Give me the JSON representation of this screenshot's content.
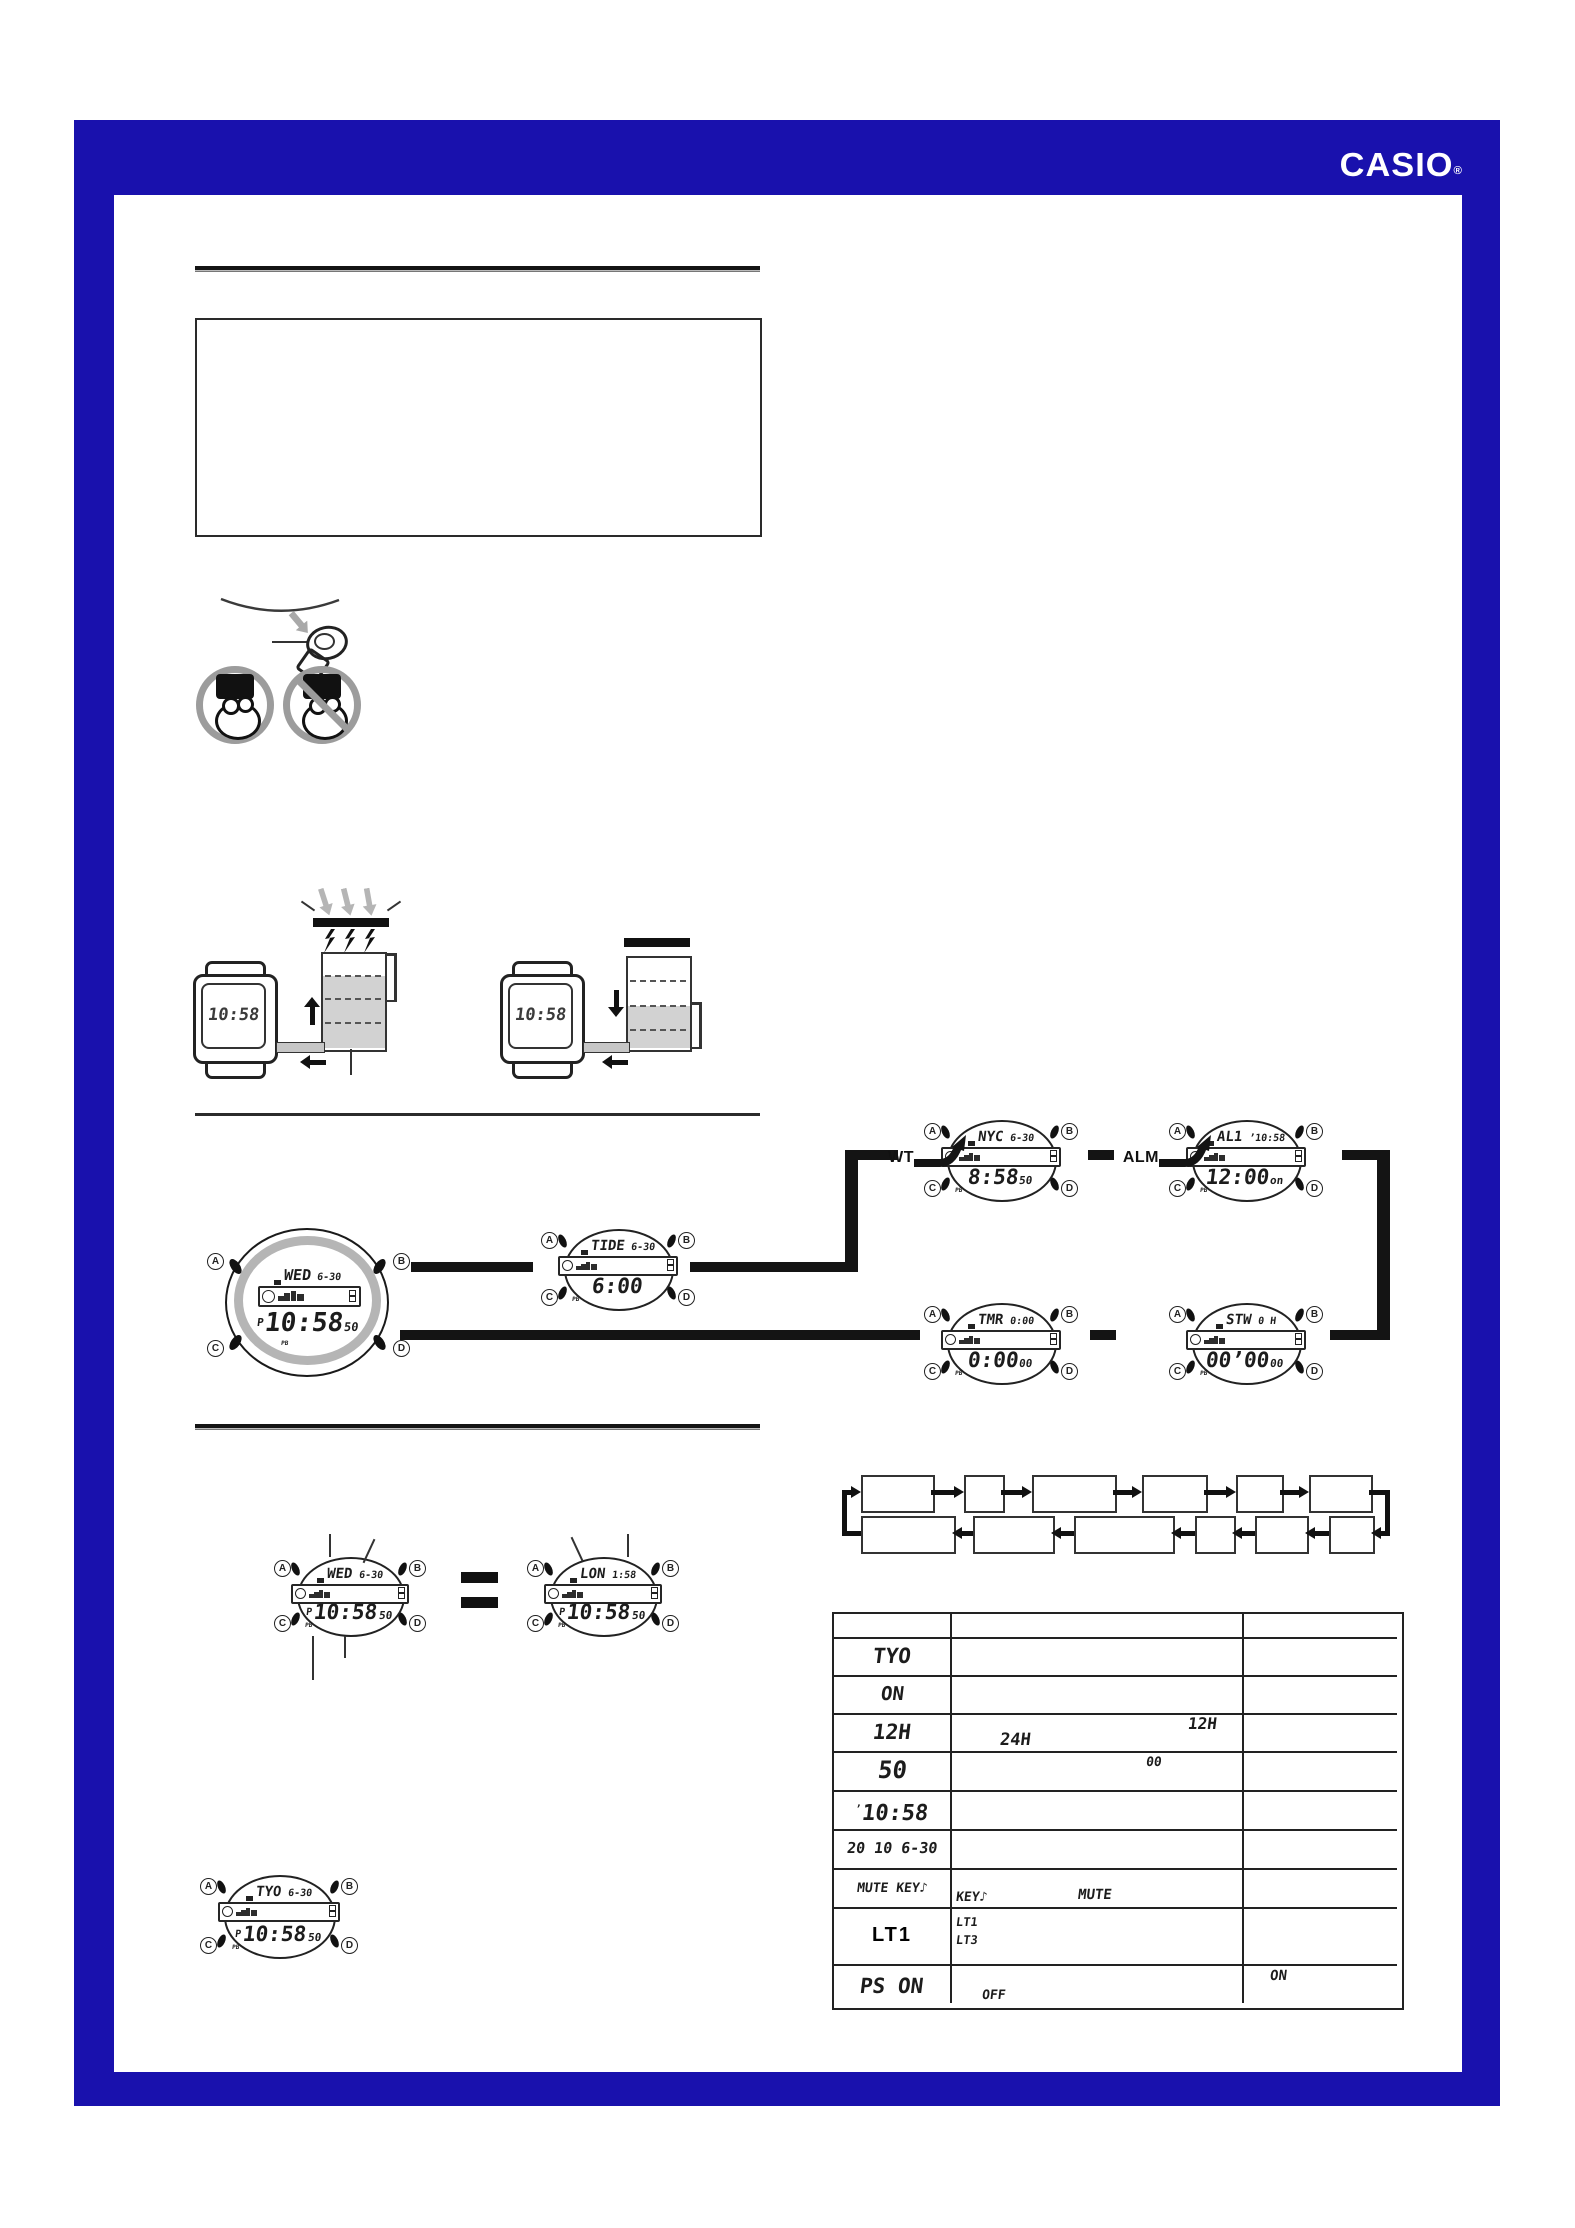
{
  "page": {
    "background": "#ffffff",
    "frame_color": "#1911ad",
    "line_color": "#141414"
  },
  "header": {
    "logo": "CASIO",
    "registered": "®"
  },
  "button_letters": [
    "A",
    "B",
    "C",
    "D"
  ],
  "charge_diagram": {
    "left_watch_time": "10:58",
    "right_watch_time": "10:58",
    "light_icon": "light-rays-arrows",
    "bolt_icon": "charge-lightning-bolts"
  },
  "mode_nav": {
    "main_watch": {
      "city": "WED",
      "date": "6-30",
      "prefix": "P",
      "time": "10:58",
      "suffix": "50",
      "sub": "PB"
    },
    "watches": [
      {
        "id": "tide",
        "city": "TIDE",
        "date": "6-30",
        "prefix": "",
        "time": "6:00",
        "suffix": "",
        "sub": "PB"
      },
      {
        "id": "wt",
        "label": "WT",
        "city": "NYC",
        "date": "6-30",
        "prefix": "",
        "time": "8:58",
        "suffix": "50",
        "sub": "PB"
      },
      {
        "id": "alm",
        "label": "ALM",
        "city": "AL1",
        "date": "’10:58",
        "prefix": "",
        "time": "12:00",
        "suffix": "on",
        "sub": "PB"
      },
      {
        "id": "tmr",
        "city": "TMR",
        "date": "0:00",
        "prefix": "",
        "time": "0:00",
        "suffix": "00",
        "sub": "PB"
      },
      {
        "id": "stw",
        "city": "STW",
        "date": "0 H",
        "prefix": "",
        "time": "00’00",
        "suffix": "00",
        "sub": "PB"
      }
    ]
  },
  "comparison": {
    "equals_symbol": "=",
    "left": {
      "city": "WED",
      "date": "6-30",
      "prefix": "P",
      "time": "10:58",
      "suffix": "50",
      "sub": "PB"
    },
    "right": {
      "city": "LON",
      "date": "1:58",
      "prefix": "P",
      "time": "10:58",
      "suffix": "50",
      "sub": "PB"
    }
  },
  "home_watch": {
    "city": "TYO",
    "date": "6-30",
    "prefix": "P",
    "time": "10:58",
    "suffix": "50",
    "sub": "PB"
  },
  "settings_table": {
    "rows": [
      {
        "label": "",
        "size": 0
      },
      {
        "label": "TYO",
        "size": 21
      },
      {
        "label": "ON",
        "size": 19
      },
      {
        "label": "12H",
        "size": 21,
        "extras": [
          {
            "text": "24H",
            "x": 50,
            "y": 17,
            "size": 17
          },
          {
            "text": "12H",
            "x": 238,
            "y": 1,
            "size": 16
          }
        ]
      },
      {
        "label": "50",
        "size": 24,
        "extras": [
          {
            "text": "00",
            "x": 196,
            "y": 2,
            "size": 13
          }
        ]
      },
      {
        "label": "10:58",
        "size": 22,
        "pre": "’"
      },
      {
        "label": "20 10  6-30",
        "size": 15
      },
      {
        "label": "MUTE KEY♪",
        "size": 13,
        "extras": [
          {
            "text": "KEY♪",
            "x": 6,
            "y": 20,
            "size": 13
          },
          {
            "text": "MUTE",
            "x": 128,
            "y": 18,
            "size": 14
          }
        ]
      },
      {
        "label": "LT1",
        "size": 20,
        "plain": true,
        "extras": [
          {
            "text": "LT1",
            "x": 6,
            "y": 6,
            "size": 12
          },
          {
            "text": "LT3",
            "x": 6,
            "y": 24,
            "size": 12
          }
        ]
      },
      {
        "label": "PS ON",
        "size": 21,
        "extras": [
          {
            "text": "ON",
            "x": 320,
            "y": 3,
            "size": 14
          },
          {
            "text": "OFF",
            "x": 32,
            "y": 22,
            "size": 13
          }
        ]
      }
    ]
  },
  "flowchart": {
    "top_boxes": [
      "",
      "",
      "",
      "",
      "",
      ""
    ],
    "bottom_boxes": [
      "",
      "",
      "",
      "",
      "",
      ""
    ]
  }
}
